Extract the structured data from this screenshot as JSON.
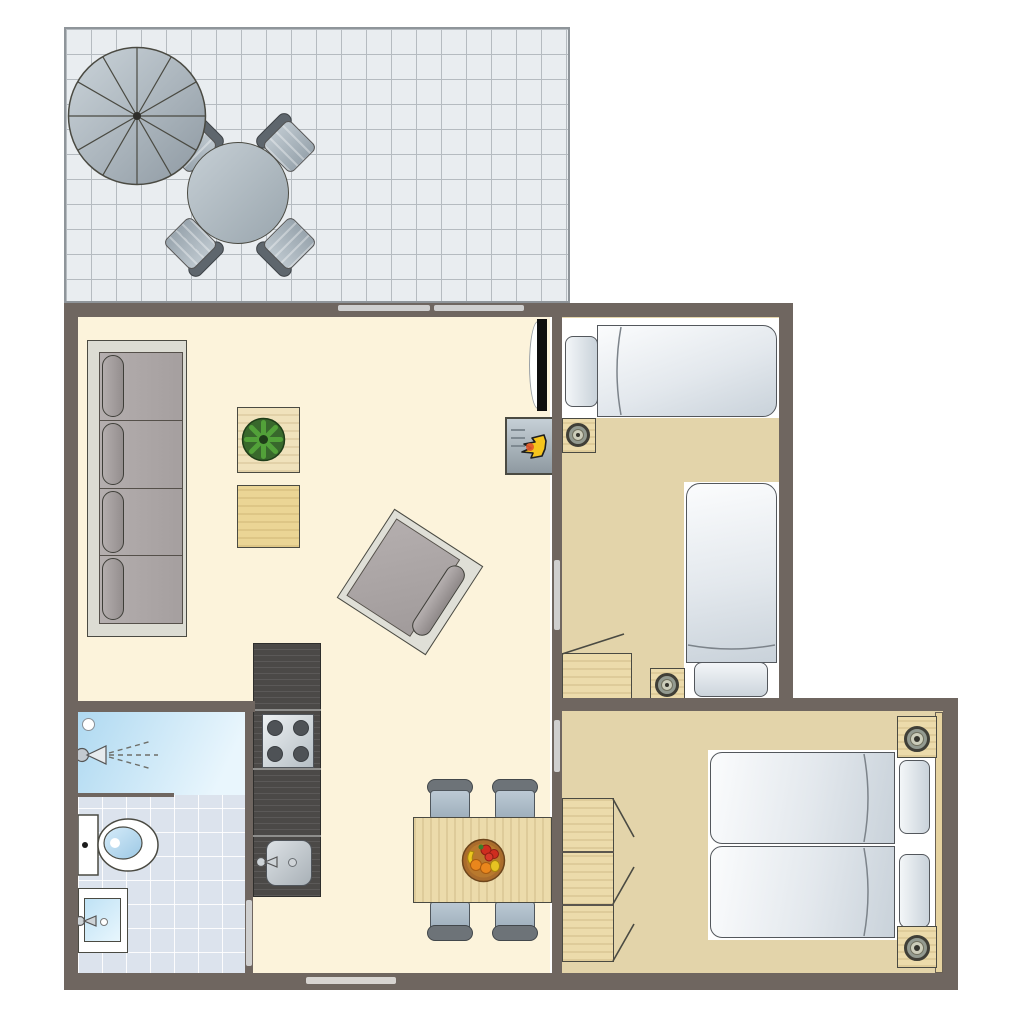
{
  "meta": {
    "type": "floor-plan",
    "description": "top-view apartment floor plan with terrace, living room, kitchen, bathroom, dining area and two bedrooms"
  },
  "colors": {
    "wall": "#6F6660",
    "door": "#CFCFCF",
    "floor-living": "#FCF3DB",
    "floor-bedroom": "#E3D4AA",
    "bath-tile": "#DCE3ED",
    "terrace-tile": "#E9EDF0",
    "terrace-line": "#B5BBC0",
    "wood": "#ECDBAB",
    "counter": "#4B4947",
    "outline": "#4A4A42",
    "sofa-frame": "#DCDCD3",
    "cushion": "#ADA7A7",
    "mattress-hi": "#FBFCFD",
    "mattress-lo": "#C9D2DA",
    "chair-seat-hi": "#BCC9D4",
    "chair-seat-lo": "#9DAEBB",
    "chair-back": "#6D7378",
    "metal-hi": "#C6CFD5",
    "metal-lo": "#9AA6AE",
    "shower-hi": "#E9F6FD",
    "shower-lo": "#AFD9F1",
    "flame": "#F6C51D",
    "plant": "#52A139",
    "fruit-bowl": "#AA6C2C"
  },
  "rooms": {
    "terrace": {
      "items": [
        "parasol",
        "round-table",
        "outdoor-chair",
        "outdoor-chair",
        "outdoor-chair",
        "outdoor-chair"
      ]
    },
    "living_room": {
      "items": [
        "sofa-4-seat",
        "side-table-with-plant",
        "side-table",
        "armchair",
        "tv",
        "wood-stove"
      ]
    },
    "kitchen": {
      "items": [
        "counter",
        "hob-4-burner",
        "sink-with-faucet"
      ]
    },
    "bathroom": {
      "items": [
        "shower-with-head",
        "toilet",
        "washbasin-with-faucet"
      ]
    },
    "dining_area": {
      "items": [
        "dining-table",
        "dining-chair",
        "dining-chair",
        "dining-chair",
        "dining-chair",
        "fruit-bowl"
      ]
    },
    "bedroom_1": {
      "items": [
        "single-bed",
        "single-bed",
        "nightstand-with-lamp",
        "nightstand-with-lamp",
        "cabinet-open-door"
      ]
    },
    "bedroom_2": {
      "items": [
        "double-bed",
        "nightstand-with-lamp",
        "nightstand-with-lamp",
        "wardrobe-3-section",
        "headboard-strip"
      ]
    }
  },
  "openings": {
    "sliding_door_segments": 2,
    "interior_doors": 3,
    "window_segments": 1
  }
}
